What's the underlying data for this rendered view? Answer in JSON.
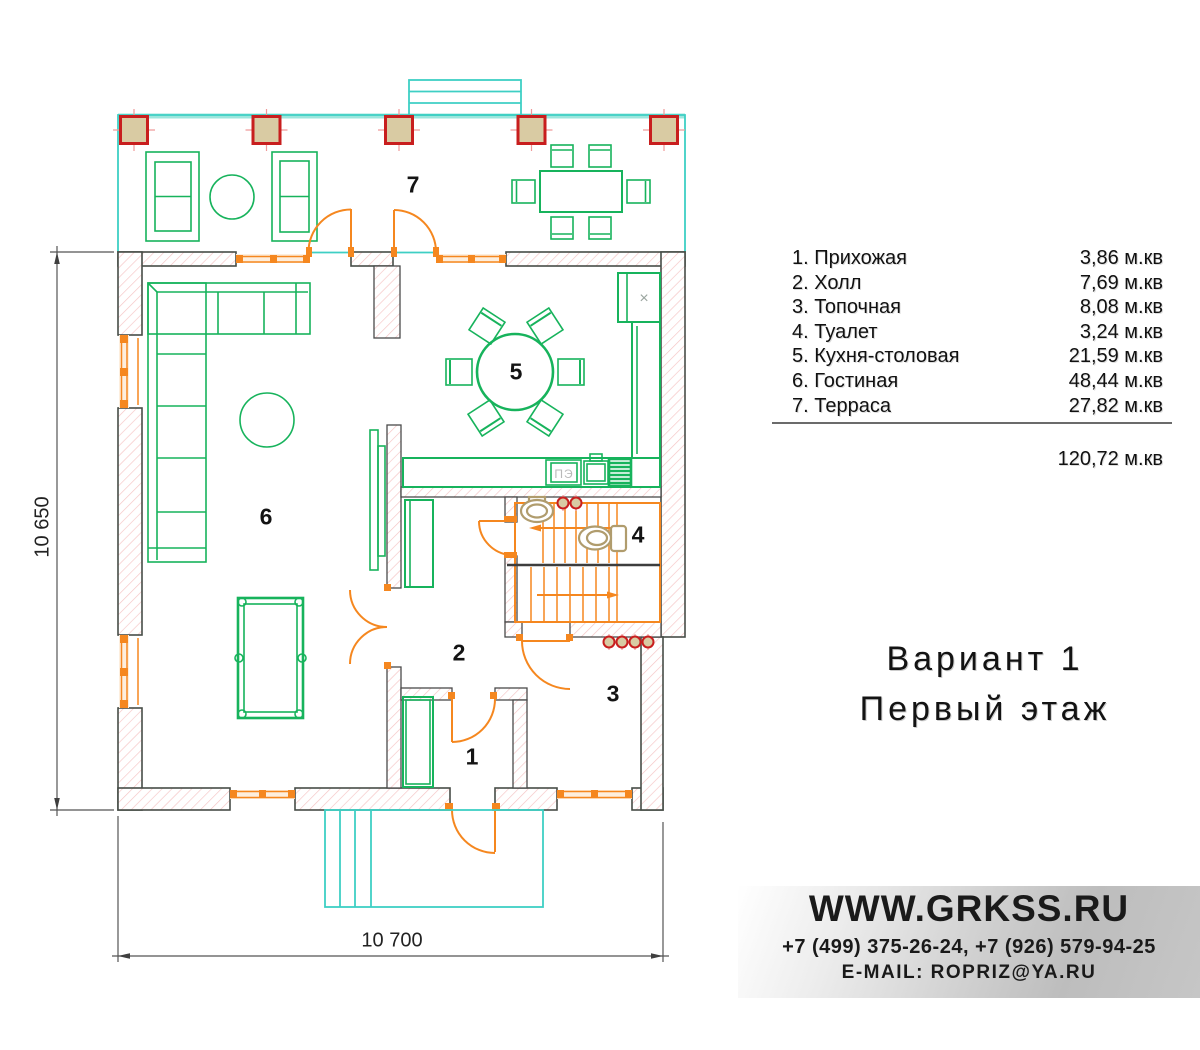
{
  "plan": {
    "dim_width": "10 700",
    "dim_height": "10 650",
    "stove_label": "ПЭ",
    "fridge_mark": "×",
    "room_labels": [
      {
        "num": "1",
        "x": 472,
        "y": 757
      },
      {
        "num": "2",
        "x": 459,
        "y": 653
      },
      {
        "num": "3",
        "x": 613,
        "y": 694
      },
      {
        "num": "4",
        "x": 638,
        "y": 535
      },
      {
        "num": "5",
        "x": 516,
        "y": 372
      },
      {
        "num": "6",
        "x": 266,
        "y": 517
      },
      {
        "num": "7",
        "x": 413,
        "y": 185
      }
    ]
  },
  "legend": {
    "rows": [
      {
        "label": "1. Прихожая",
        "area": "3,86 м.кв"
      },
      {
        "label": "2. Холл",
        "area": "7,69 м.кв"
      },
      {
        "label": "3. Топочная",
        "area": "8,08 м.кв"
      },
      {
        "label": "4. Туалет",
        "area": "3,24 м.кв"
      },
      {
        "label": "5. Кухня-столовая",
        "area": "21,59 м.кв"
      },
      {
        "label": "6. Гостиная",
        "area": "48,44 м.кв"
      },
      {
        "label": "7. Терраса",
        "area": "27,82 м.кв"
      }
    ],
    "total": "120,72 м.кв"
  },
  "title": {
    "line1": "Вариант 1",
    "line2": "Первый этаж"
  },
  "contact": {
    "website": "WWW.GRKSS.RU",
    "phones": "+7 (499) 375-26-24, +7 (926) 579-94-25",
    "email": "E-MAIL: ROPRIZ@YA.RU"
  },
  "colors": {
    "plan_green": "#17b35c",
    "plan_orange": "#f5871f",
    "plan_cyan": "#3ecfc4",
    "plan_red": "#c81e1e",
    "column_fill": "#d9cba3",
    "fixture_tan": "#b09c6d",
    "wall_line": "#474d47",
    "hatch": "#f5c4c4"
  }
}
